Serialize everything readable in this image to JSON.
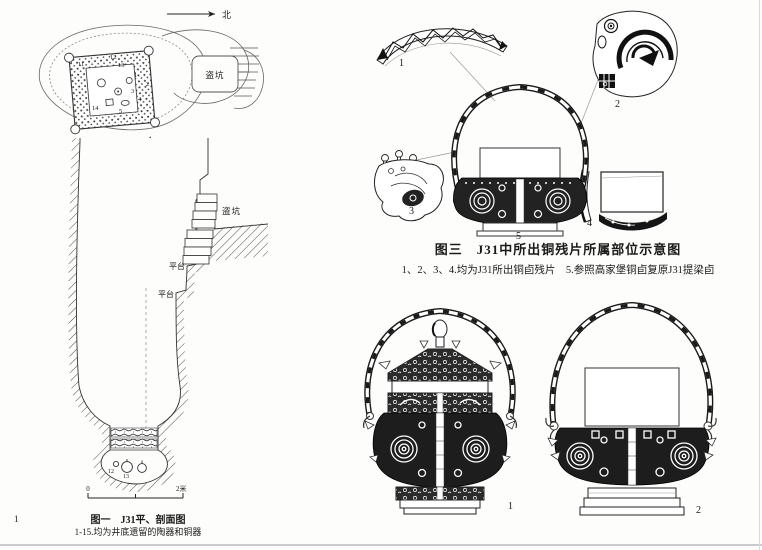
{
  "page": {
    "number": "1"
  },
  "figure1": {
    "north_label": "北",
    "plan": {
      "robber_pit": "盗坑",
      "figure_mark": "1",
      "items": [
        "11",
        "12",
        "13",
        "1",
        "2",
        "3",
        "4",
        "5",
        "14"
      ]
    },
    "section": {
      "robber_pit": "盗坑",
      "platform_upper": "平台",
      "platform_lower": "平台",
      "bottom_items": [
        "12",
        "13"
      ]
    },
    "scale": {
      "zero": "0",
      "two_m": "2米"
    },
    "caption_title": "图一　J31平、剖面图",
    "caption_note": "1-15.均为井底遗留的陶器和铜器"
  },
  "figure3": {
    "caption_title": "图三　J31中所出铜残片所属部位示意图",
    "caption_note": "1、2、3、4.均为J31所出铜卣残片　5.参照高家堡铜卣复原J31提梁卣",
    "fragment_labels": [
      "1",
      "2",
      "3",
      "4",
      "5"
    ],
    "vessel_labels": [
      "1",
      "2"
    ]
  }
}
